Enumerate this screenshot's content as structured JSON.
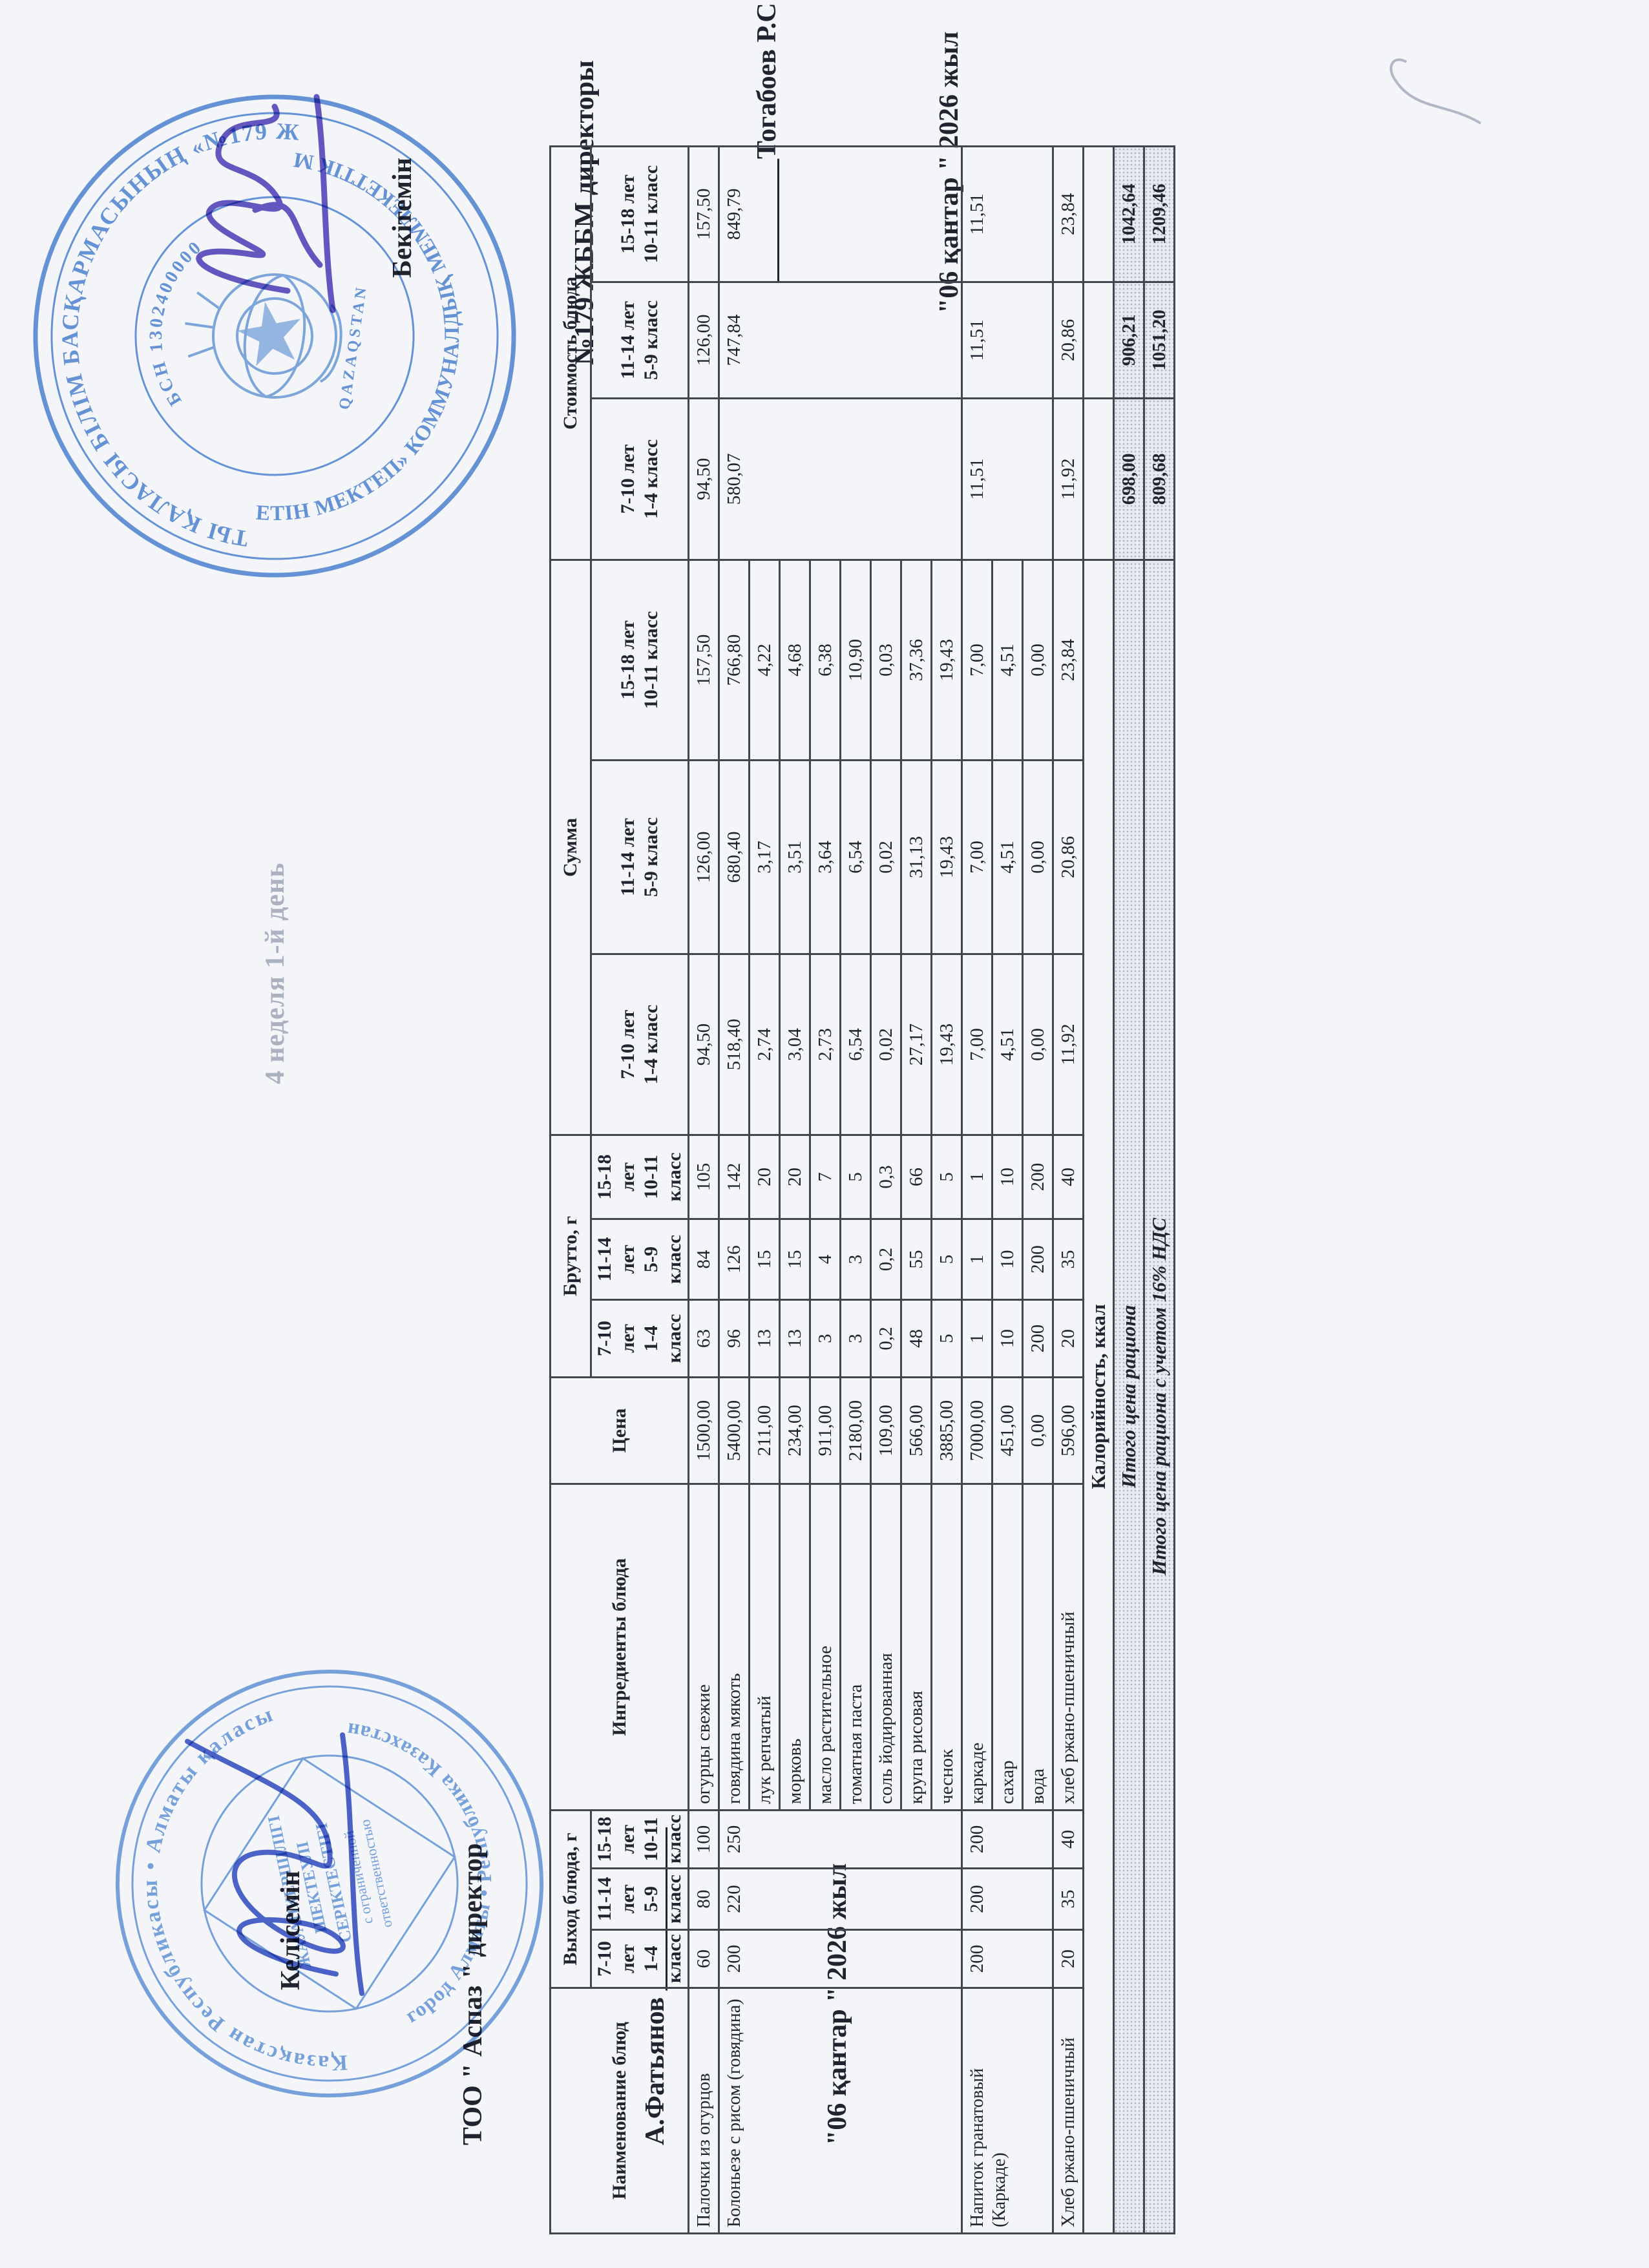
{
  "page": {
    "week_label": "4 неделя 1-й день",
    "agreement": {
      "line1": "Келісемін",
      "line2": "ТОО \" Аспаз \" директор",
      "line3": "А.Фатьянов ____________",
      "line4": "\"06 қантар \" 2026 жыл"
    },
    "approval": {
      "line1": "Бекітемін",
      "line2": "№179 ЖББМ директоры",
      "line3": "_________Тогабоев Р.С",
      "line4": "\"06 қантар \" 2026 жыл"
    }
  },
  "table": {
    "headers": {
      "name": "Наименование блюд",
      "out_group": "Выход блюда, г",
      "ingredients": "Ингредиенты блюда",
      "price": "Цена",
      "brutto_group": "Брутто, г",
      "sum_group": "Сумма",
      "cost_group": "Стоимость блюда"
    },
    "age": [
      {
        "l1": "7-10 лет",
        "l2": "1-4 класс"
      },
      {
        "l1": "11-14 лет",
        "l2": "5-9 класс"
      },
      {
        "l1": "15-18 лет",
        "l2": "10-11 класс"
      }
    ],
    "dishes": [
      {
        "name": "Палочки из огурцов",
        "out": [
          "60",
          "80",
          "100"
        ],
        "cost": [
          "94,50",
          "126,00",
          "157,50"
        ],
        "ingredients": [
          {
            "name": "огурцы свежие",
            "price": "1500,00",
            "brutto": [
              "63",
              "84",
              "105"
            ],
            "sum": [
              "94,50",
              "126,00",
              "157,50"
            ]
          }
        ]
      },
      {
        "name": "Болоньезе с рисом (говядина)",
        "out": [
          "200",
          "220",
          "250"
        ],
        "cost": [
          "580,07",
          "747,84",
          "849,79"
        ],
        "ingredients": [
          {
            "name": "говядина мякоть",
            "price": "5400,00",
            "brutto": [
              "96",
              "126",
              "142"
            ],
            "sum": [
              "518,40",
              "680,40",
              "766,80"
            ]
          },
          {
            "name": "лук репчатый",
            "price": "211,00",
            "brutto": [
              "13",
              "15",
              "20"
            ],
            "sum": [
              "2,74",
              "3,17",
              "4,22"
            ]
          },
          {
            "name": "морковь",
            "price": "234,00",
            "brutto": [
              "13",
              "15",
              "20"
            ],
            "sum": [
              "3,04",
              "3,51",
              "4,68"
            ]
          },
          {
            "name": "масло растительное",
            "price": "911,00",
            "brutto": [
              "3",
              "4",
              "7"
            ],
            "sum": [
              "2,73",
              "3,64",
              "6,38"
            ]
          },
          {
            "name": "томатная паста",
            "price": "2180,00",
            "brutto": [
              "3",
              "3",
              "5"
            ],
            "sum": [
              "6,54",
              "6,54",
              "10,90"
            ]
          },
          {
            "name": "соль йодированная",
            "price": "109,00",
            "brutto": [
              "0,2",
              "0,2",
              "0,3"
            ],
            "sum": [
              "0,02",
              "0,02",
              "0,03"
            ]
          },
          {
            "name": "крупа рисовая",
            "price": "566,00",
            "brutto": [
              "48",
              "55",
              "66"
            ],
            "sum": [
              "27,17",
              "31,13",
              "37,36"
            ]
          },
          {
            "name": "чеснок",
            "price": "3885,00",
            "brutto": [
              "5",
              "5",
              "5"
            ],
            "sum": [
              "19,43",
              "19,43",
              "19,43"
            ]
          }
        ]
      },
      {
        "name": "Напиток гранатовый (Каркаде)",
        "out": [
          "200",
          "200",
          "200"
        ],
        "cost": [
          "11,51",
          "11,51",
          "11,51"
        ],
        "ingredients": [
          {
            "name": "каркаде",
            "price": "7000,00",
            "brutto": [
              "1",
              "1",
              "1"
            ],
            "sum": [
              "7,00",
              "7,00",
              "7,00"
            ]
          },
          {
            "name": "сахар",
            "price": "451,00",
            "brutto": [
              "10",
              "10",
              "10"
            ],
            "sum": [
              "4,51",
              "4,51",
              "4,51"
            ]
          },
          {
            "name": "вода",
            "price": "0,00",
            "brutto": [
              "200",
              "200",
              "200"
            ],
            "sum": [
              "0,00",
              "0,00",
              "0,00"
            ]
          }
        ]
      },
      {
        "name": "Хлеб ржано-пшеничный",
        "out": [
          "20",
          "35",
          "40"
        ],
        "cost": [
          "11,92",
          "20,86",
          "23,84"
        ],
        "ingredients": [
          {
            "name": "хлеб ржано-пшеничный",
            "price": "596,00",
            "brutto": [
              "20",
              "35",
              "40"
            ],
            "sum": [
              "11,92",
              "20,86",
              "23,84"
            ]
          }
        ]
      }
    ],
    "totals": [
      {
        "label": "Калорийность, ккал",
        "values": [
          "",
          "",
          ""
        ]
      },
      {
        "label": "Итого цена рациона",
        "values": [
          "698,00",
          "906,21",
          "1042,64"
        ]
      },
      {
        "label": "Итого цена рациона с учетом 16% НДС",
        "values": [
          "809,68",
          "1051,20",
          "1209,46"
        ]
      }
    ]
  },
  "stamps": {
    "left": {
      "ring_top": "Қазақстан Республикасы • Алматы қаласы",
      "ring_bottom": "город Алматы • Республика Казахстан",
      "inner1": "ЖАУАПКЕРШІЛІГІ",
      "inner2": "ШЕКТЕУЛІ",
      "inner3": "СЕРІКТЕСТІГІ",
      "inner4": "с ограниченной",
      "inner5": "ответственностью"
    },
    "right": {
      "ring_top": "АЛМАТЫ ҚАЛАСЫ БІЛІМ БАСҚАРМАСЫНЫҢ «№179 ЖАЛПЫ",
      "ring_bottom": "БІЛІМ БЕРЕТІН МЕКТЕП» КОММУНАЛДЫҚ МЕМЛЕКЕТТІК МЕКЕМЕСІ",
      "ring_inner": "БСН 1302400000",
      "center": "QAZAQSTAN"
    }
  }
}
